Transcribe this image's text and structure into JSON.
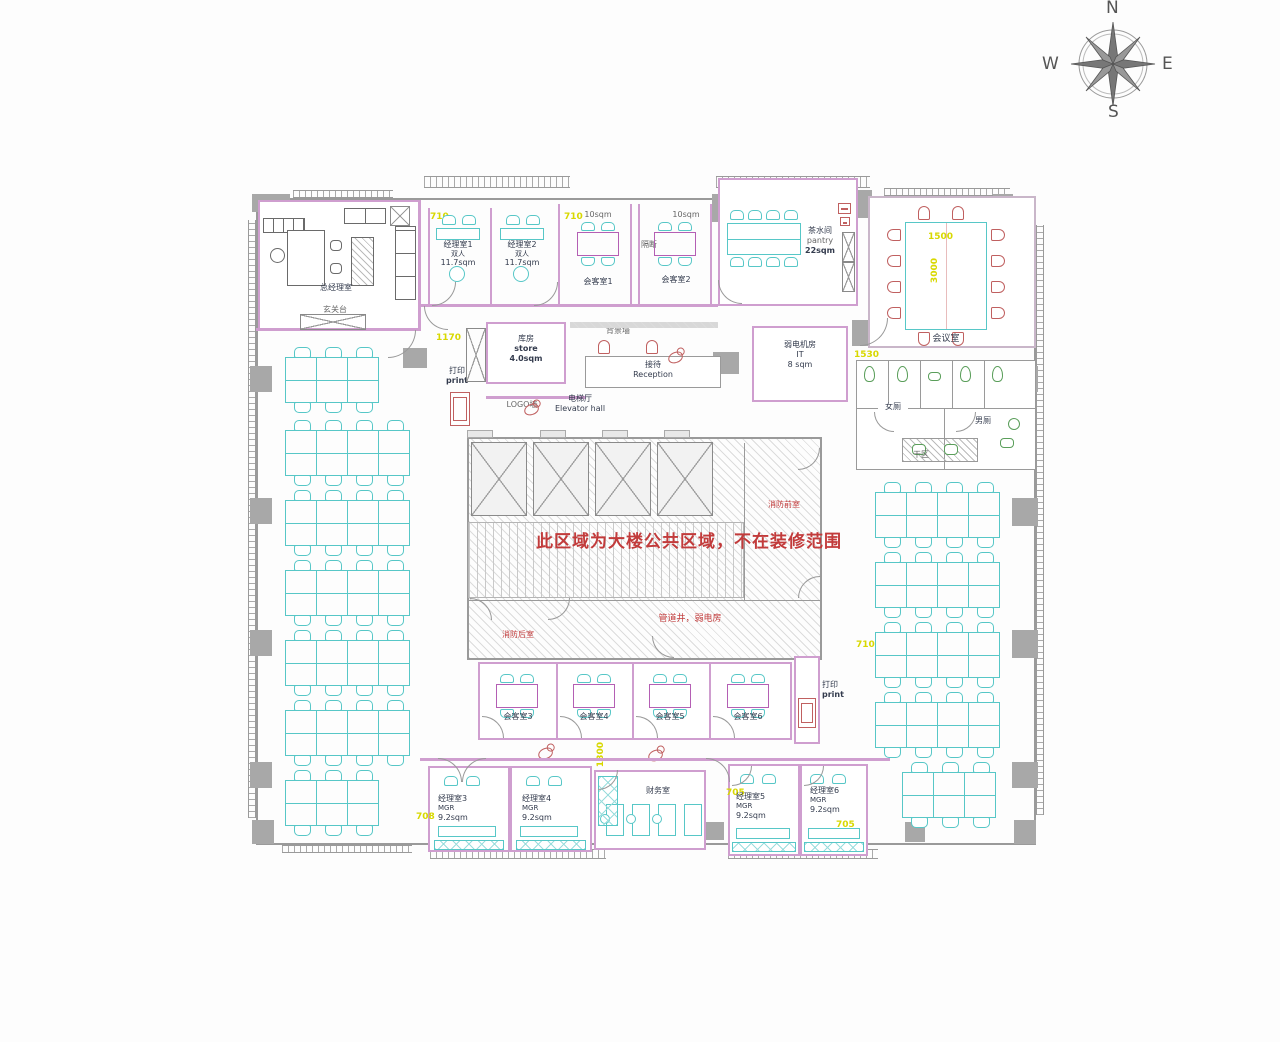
{
  "compass": {
    "north": "N",
    "south": "S",
    "east": "E",
    "west": "W"
  },
  "notices": {
    "public_area": "此区域为大楼公共区域，不在装修范围",
    "fire_front": "消防前室",
    "fire_rear": "消防后室",
    "pipe_shaft": "管道井，弱电房"
  },
  "rooms": {
    "gm_office": "总经理室",
    "entry_console": "玄关台",
    "mgr1_name": "经理室1",
    "mgr1_type": "双人",
    "mgr1_area": "11.7sqm",
    "mgr2_name": "经理室2",
    "mgr2_type": "双人",
    "mgr2_area": "11.7sqm",
    "meet1_area": "10sqm",
    "meet1_name": "会客室1",
    "partition": "隔断",
    "meet2_area": "10sqm",
    "meet2_name": "会客室2",
    "pantry_name": "茶水间",
    "pantry_en": "pantry",
    "pantry_area": "22sqm",
    "conference": "会议室",
    "store_name": "库房",
    "store_en": "store",
    "store_area": "4.0sqm",
    "bg_wall": "背景墙",
    "reception_name": "接待",
    "reception_en": "Reception",
    "logo_wall": "LOGO墙",
    "elevator_name": "电梯厅",
    "elevator_en": "Elevator hall",
    "it_name": "弱电机房",
    "it_en": "IT",
    "it_area": "8 sqm",
    "wc_women": "女厕",
    "wc_men": "男厕",
    "wc_dry": "干区",
    "print_top_cn": "打印",
    "print_top_en": "print",
    "print_bottom_cn": "打印",
    "print_bottom_en": "print",
    "meet3": "会客室3",
    "meet4": "会客室4",
    "meet5": "会客室5",
    "meet6": "会客室6",
    "mgr3_name": "经理室3",
    "mgr3_type": "MGR",
    "mgr3_area": "9.2sqm",
    "mgr4_name": "经理室4",
    "mgr4_type": "MGR",
    "mgr4_area": "9.2sqm",
    "finance": "财务室",
    "mgr5_name": "经理室5",
    "mgr5_type": "MGR",
    "mgr5_area": "9.2sqm",
    "mgr6_name": "经理室6",
    "mgr6_type": "MGR",
    "mgr6_area": "9.2sqm"
  },
  "dims": {
    "a710": "710",
    "b710": "710",
    "c1170": "1170",
    "d1530": "1530",
    "e1500": "1500",
    "f3000": "3000",
    "g710": "710",
    "h705": "705",
    "i705": "705",
    "j708": "708",
    "k1300": "1300"
  },
  "colors": {
    "wall_pink": "#cf9ecf",
    "furniture_cyan": "#57c7c7",
    "notice_red": "#c23b3b",
    "dimension_yellow": "#d8d800",
    "column_gray": "#a8a8a8",
    "fixture_green": "#5a9e5a",
    "conference_chair_red": "#c06060"
  }
}
